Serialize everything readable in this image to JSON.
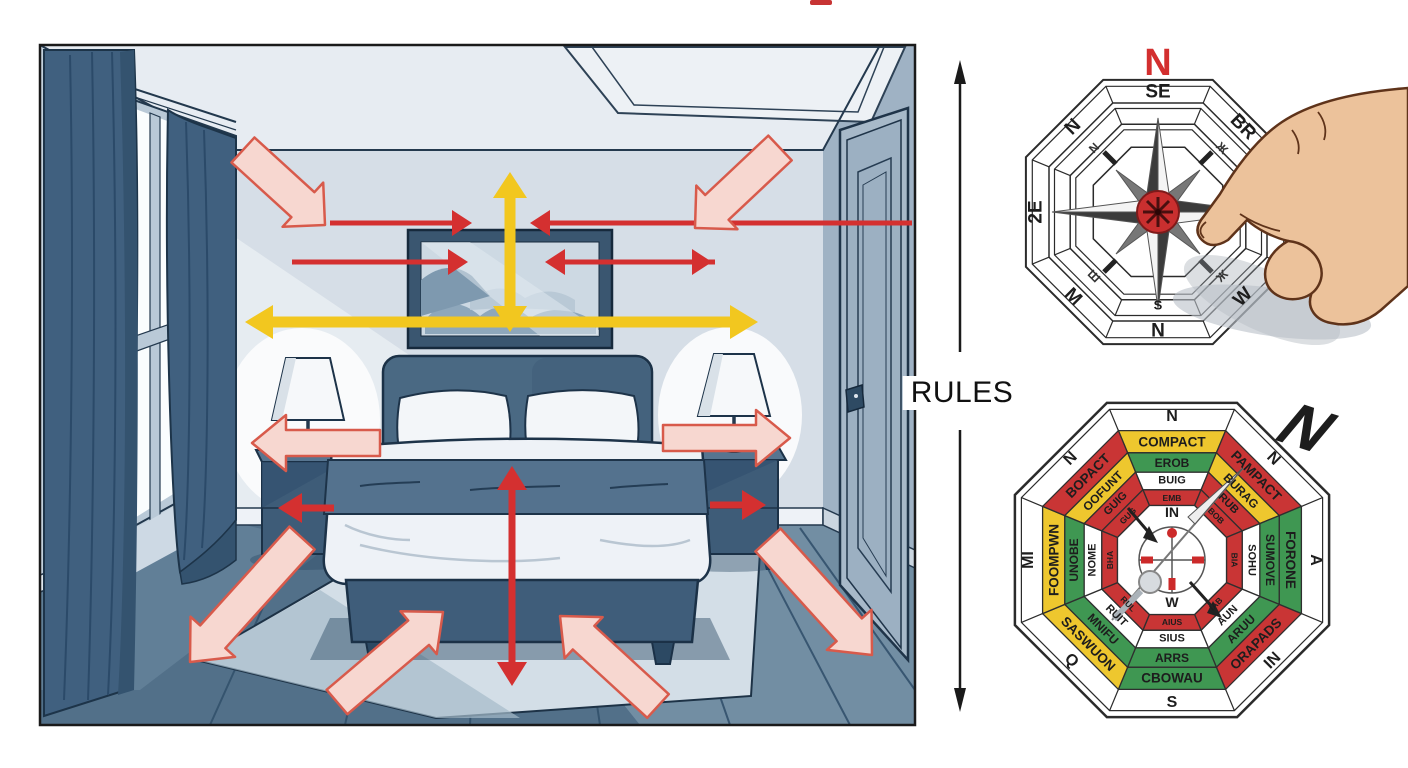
{
  "divider": {
    "label": "RULES"
  },
  "palette": {
    "white": "#ffffff",
    "bagua_yellow": "#eec72e",
    "bagua_red": "#c93535",
    "bagua_green": "#3f9752",
    "arrow_red": "#d43030",
    "arrow_yellow": "#f2c71f",
    "arrow_pink_fill": "#f7d7d0",
    "arrow_pink_stroke": "#d85a4b",
    "compass_north": "#d32f2f",
    "divider_color": "#1a1a1a"
  },
  "compass": {
    "north": "N",
    "labels": {
      "top": "SE",
      "ne": "BR",
      "se": "W",
      "s": "N",
      "sw": "M",
      "w": "2E",
      "nw": "N",
      "inner_s": "S"
    },
    "glyphs": {
      "nw": "N",
      "ne": "Ж",
      "sw": "Ш",
      "se": "Ж"
    }
  },
  "bagua": {
    "big_direction": "N",
    "outer": {
      "n": "N",
      "ne": "N",
      "e": "A",
      "se": "IN",
      "s": "S",
      "sw": "Q",
      "w": "MI",
      "nw": "N"
    },
    "ring1": {
      "n": {
        "text": "COMPACT",
        "color": "bagua_yellow"
      },
      "ne": {
        "text": "PAMPACT",
        "color": "bagua_red"
      },
      "e": {
        "text": "FORONE",
        "color": "bagua_green"
      },
      "se": {
        "text": "ORAPADS",
        "color": "bagua_red"
      },
      "s": {
        "text": "CBOWAU",
        "color": "bagua_green"
      },
      "sw": {
        "text": "SASWUON",
        "color": "bagua_yellow"
      },
      "w": {
        "text": "FOOMPWN",
        "color": "bagua_yellow"
      },
      "nw": {
        "text": "BOPACT",
        "color": "bagua_red"
      }
    },
    "ring2": {
      "n": {
        "text": "EROB",
        "color": "bagua_green"
      },
      "ne": {
        "text": "BURAG",
        "color": "bagua_yellow"
      },
      "e": {
        "text": "SUMOVE",
        "color": "bagua_green"
      },
      "se": {
        "text": "ARUU",
        "color": "bagua_green"
      },
      "s": {
        "text": "ARRS",
        "color": "bagua_green"
      },
      "sw": {
        "text": "MNIFU",
        "color": "bagua_green"
      },
      "w": {
        "text": "UNOBE",
        "color": "bagua_green"
      },
      "nw": {
        "text": "OOFUNT",
        "color": "bagua_yellow"
      }
    },
    "ring3": {
      "n": {
        "text": "BUIG",
        "color": "white"
      },
      "ne": {
        "text": "RUB",
        "color": "bagua_red"
      },
      "e": {
        "text": "SOHU",
        "color": "white"
      },
      "se": {
        "text": "AUN",
        "color": "white"
      },
      "s": {
        "text": "SIUS",
        "color": "white"
      },
      "sw": {
        "text": "RUIT",
        "color": "white"
      },
      "w": {
        "text": "NOME",
        "color": "white"
      },
      "nw": {
        "text": "GUIG",
        "color": "bagua_red"
      }
    },
    "ring4": {
      "n": {
        "text": "EMB",
        "color": "bagua_red"
      },
      "ne": {
        "text": "BOB",
        "color": "bagua_red"
      },
      "e": {
        "text": "BIA",
        "color": "bagua_red"
      },
      "se": {
        "text": "IAB",
        "color": "bagua_red"
      },
      "s": {
        "text": "AIUS",
        "color": "bagua_red"
      },
      "sw": {
        "text": "RUL",
        "color": "bagua_red"
      },
      "w": {
        "text": "BHA",
        "color": "bagua_red"
      },
      "nw": {
        "text": "GUG",
        "color": "bagua_red"
      }
    },
    "inner": {
      "top": "IN",
      "bottom": "W"
    }
  }
}
